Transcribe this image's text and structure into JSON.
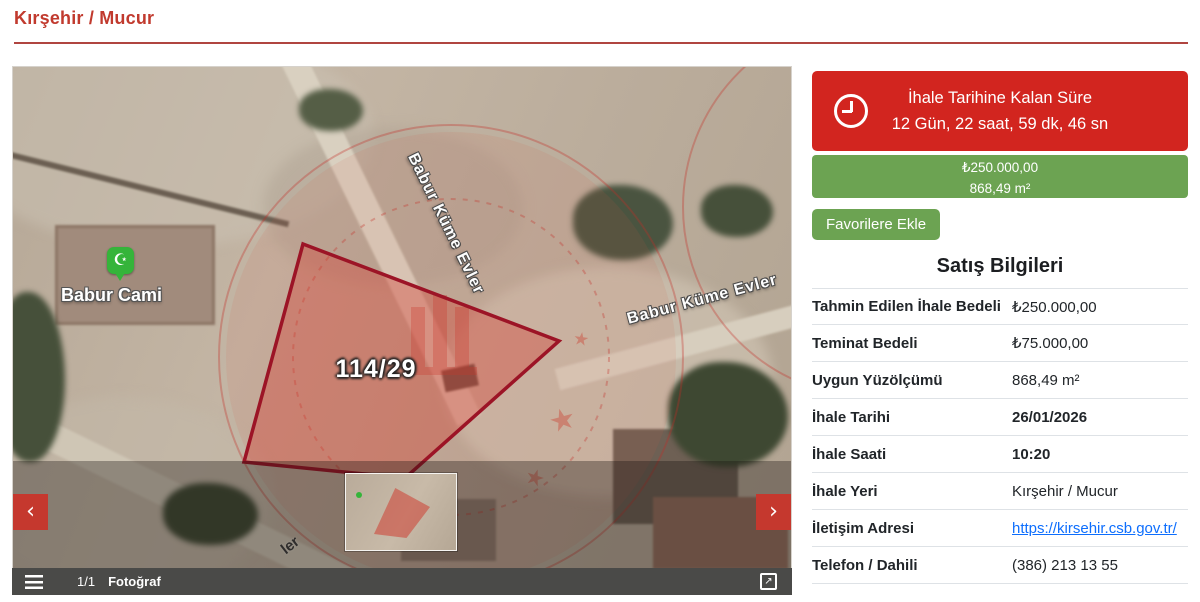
{
  "header": {
    "breadcrumb": "Kırşehir / Mucur"
  },
  "map": {
    "parcel_label": "114/29",
    "poi_label": "Babur Cami",
    "poi_icon": "☪",
    "street_label_main": "Babur Küme Evler",
    "street_label_right": "Babur Küme Evler",
    "street_label_fragment": "ler"
  },
  "viewer": {
    "counter": "1/1",
    "photo_label": "Fotoğraf",
    "prev_icon": "‹",
    "next_icon": "›",
    "expand_icon": "↗"
  },
  "countdown": {
    "title": "İhale Tarihine Kalan Süre",
    "remaining": "12 Gün, 22 saat, 59 dk, 46 sn"
  },
  "price_banner": {
    "price": "₺250.000,00",
    "area": "868,49 m²"
  },
  "favorite_button_label": "Favorilere Ekle",
  "sale_info": {
    "title": "Satış Bilgileri",
    "rows": [
      {
        "label": "Tahmin Edilen İhale Bedeli",
        "value": "₺250.000,00",
        "bold": false,
        "link": false
      },
      {
        "label": "Teminat Bedeli",
        "value": "₺75.000,00",
        "bold": false,
        "link": false
      },
      {
        "label": "Uygun Yüzölçümü",
        "value": "868,49 m²",
        "bold": false,
        "link": false
      },
      {
        "label": "İhale Tarihi",
        "value": "26/01/2026",
        "bold": true,
        "link": false
      },
      {
        "label": "İhale Saati",
        "value": "10:20",
        "bold": true,
        "link": false
      },
      {
        "label": "İhale Yeri",
        "value": "Kırşehir / Mucur",
        "bold": false,
        "link": false
      },
      {
        "label": "İletişim Adresi",
        "value": "https://kirsehir.csb.gov.tr/",
        "bold": false,
        "link": true
      },
      {
        "label": "Telefon / Dahili",
        "value": "(386) 213 13 55",
        "bold": false,
        "link": false
      }
    ]
  },
  "colors": {
    "breadcrumb_red": "#c13a2e",
    "banner_red": "#d2251f",
    "arrow_red": "#c5382e",
    "green": "#6ca352",
    "parcel_stroke": "#9c1426",
    "bar_gray": "#4a4a48",
    "link_blue": "#0d6efd",
    "pin_green": "#35b43a"
  }
}
